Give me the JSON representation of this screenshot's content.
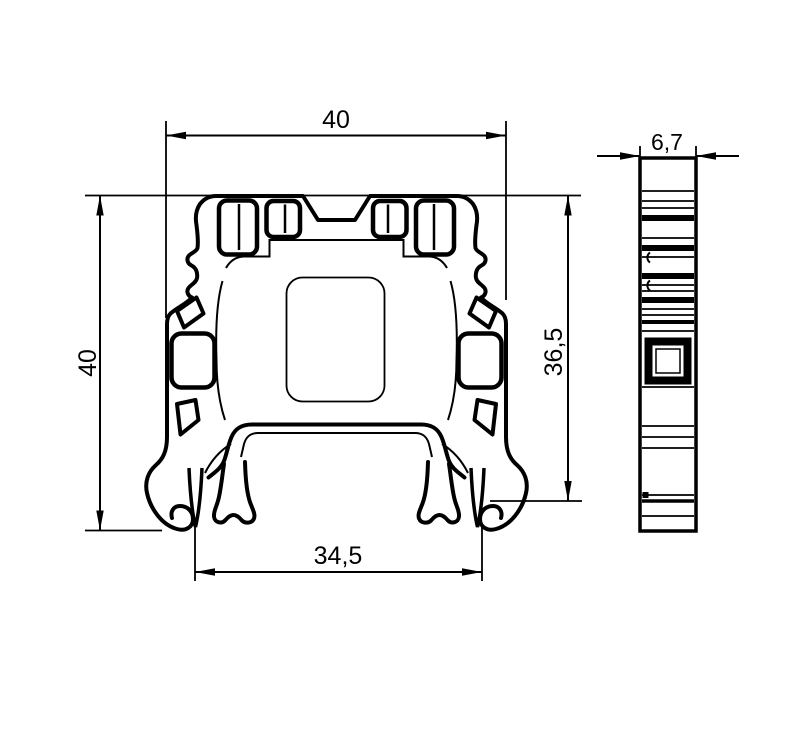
{
  "drawing": {
    "type": "technical dimension drawing",
    "subject": "DIN rail terminal block extruded profile, front section and side view",
    "colors": {
      "line": "#000000",
      "background": "#ffffff"
    }
  },
  "front_view": {
    "name": "front-profile-section",
    "dimensions": {
      "width_top": "40",
      "height_left": "40",
      "height_right": "36,5",
      "width_bottom": "34,5"
    }
  },
  "side_view": {
    "name": "side-view",
    "dimensions": {
      "width_top": "6,7"
    }
  }
}
